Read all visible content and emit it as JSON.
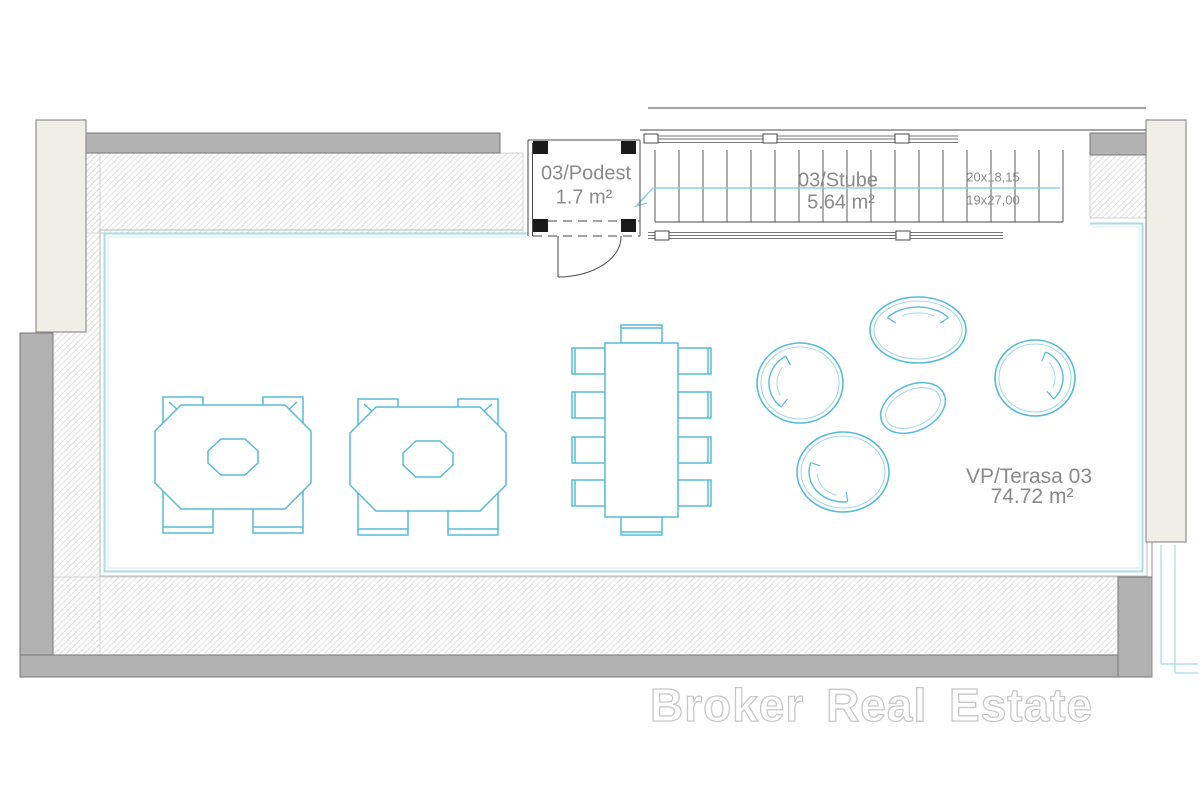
{
  "plan": {
    "title_labels": {
      "podest_name": "03/Podest",
      "podest_area": "1.7 m²",
      "stube_name": "03/Stube",
      "stube_area": "5.64 m²",
      "stair_dim_riser": "20x18,15",
      "stair_dim_tread": "19x27,00",
      "terrace_name": "VP/Terasa 03",
      "terrace_area": "74.72 m²"
    },
    "watermark": "Broker Real Estate",
    "colors": {
      "wall_gray": "#b2b2b2",
      "pier_beige": "#efeee7",
      "hatch_line": "#dedede",
      "terrace_line": "#a5dce8",
      "walk_line": "#8fd0e0",
      "furniture_main": "#58bcd8",
      "furniture_light": "#a6d9e8",
      "drawing_line": "#4a4a4a",
      "label_text": "#8a8a8a",
      "watermark_outline": "#c8c8c8"
    },
    "stairs": {
      "tread_count": 18
    },
    "furniture": {
      "octagon_table_sets": [
        {
          "x": 155,
          "y": 405
        },
        {
          "x": 350,
          "y": 407
        }
      ],
      "dining_set": {
        "x": 605,
        "y": 343
      },
      "bubble_chairs": [
        {
          "cx": 918,
          "cy": 330,
          "rx": 48,
          "ry": 33,
          "angle": -90
        },
        {
          "cx": 800,
          "cy": 383,
          "rx": 43,
          "ry": 40,
          "angle": 185
        },
        {
          "cx": 1035,
          "cy": 378,
          "rx": 40,
          "ry": 38,
          "angle": -10
        },
        {
          "cx": 843,
          "cy": 472,
          "rx": 46,
          "ry": 40,
          "angle": 140
        }
      ],
      "ottoman": {
        "cx": 913,
        "cy": 408,
        "rx": 34,
        "ry": 23,
        "rot": -25
      }
    }
  }
}
